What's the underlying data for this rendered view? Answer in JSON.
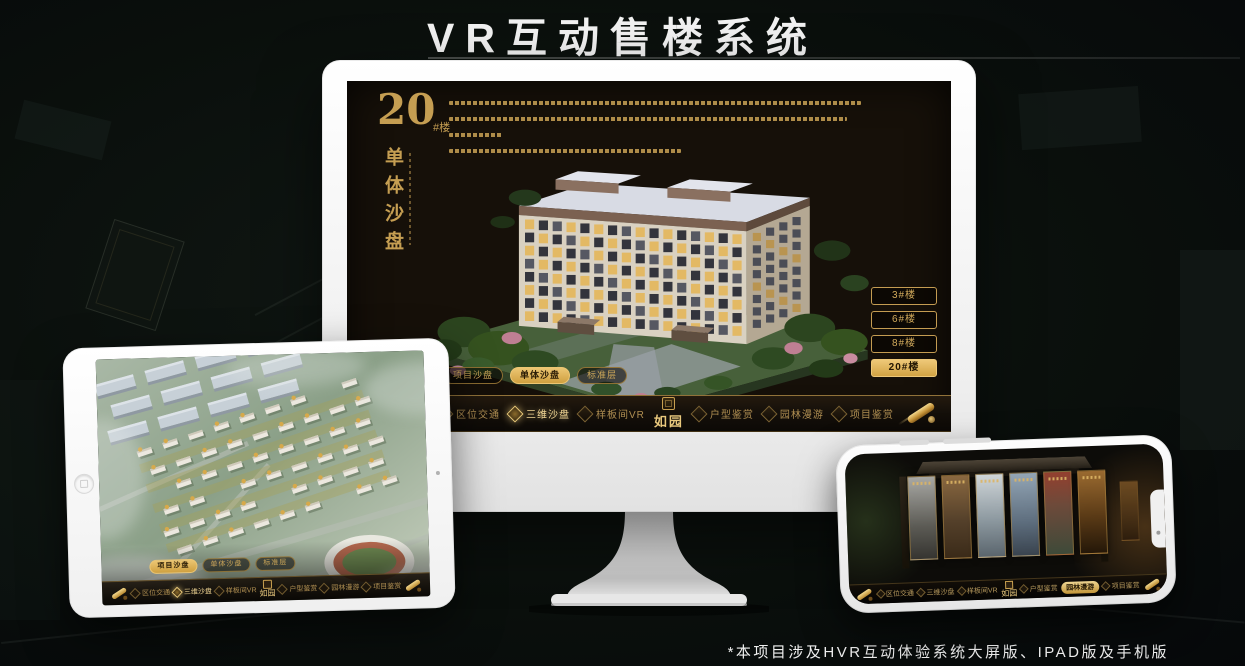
{
  "page": {
    "title": "VR互动售楼系统",
    "footnote": "*本项目涉及HVR互动体验系统大屏版、IPAD版及手机版"
  },
  "colors": {
    "gold": "#c9a050",
    "gold_bright": "#eec878",
    "screen_bg": "#161009"
  },
  "monitor": {
    "heading": {
      "number": "20",
      "unit": "#楼",
      "vertical_title": "单体沙盘"
    },
    "tabs": [
      {
        "label": "项目沙盘",
        "selected": false
      },
      {
        "label": "单体沙盘",
        "selected": true
      },
      {
        "label": "标准层",
        "selected": false
      }
    ],
    "floors": [
      {
        "label": "3#楼",
        "selected": false
      },
      {
        "label": "6#楼",
        "selected": false
      },
      {
        "label": "8#楼",
        "selected": false
      },
      {
        "label": "20#楼",
        "selected": true
      }
    ],
    "nav": {
      "items": [
        "区位交通",
        "三维沙盘",
        "样板间VR",
        "户型鉴赏",
        "园林漫游",
        "项目鉴赏"
      ],
      "active": "三维沙盘",
      "logo": "如园"
    }
  },
  "tablet": {
    "tabs": [
      {
        "label": "项目沙盘",
        "selected": true
      },
      {
        "label": "单体沙盘",
        "selected": false
      },
      {
        "label": "标准层",
        "selected": false
      }
    ],
    "nav": {
      "items": [
        "区位交通",
        "三维沙盘",
        "样板间VR",
        "户型鉴赏",
        "园林漫游",
        "项目鉴赏"
      ],
      "active": "三维沙盘",
      "logo": "如园"
    }
  },
  "phone": {
    "nav": {
      "items": [
        "区位交通",
        "三维沙盘",
        "样板间VR",
        "户型鉴赏",
        "园林漫游",
        "项目鉴赏"
      ],
      "active": "园林漫游",
      "logo": "如园"
    }
  }
}
